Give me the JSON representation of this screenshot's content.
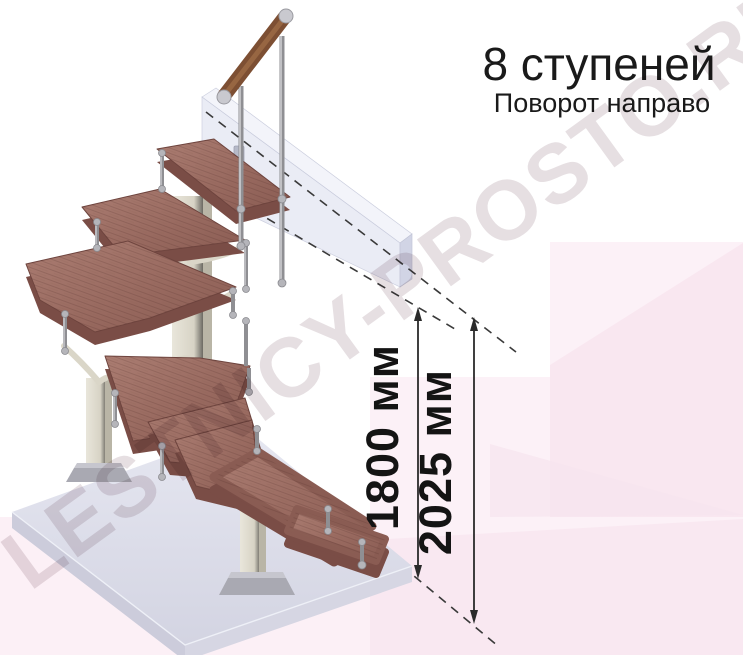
{
  "header": {
    "title": "8 ступеней",
    "subtitle": "Поворот направо"
  },
  "dimensions": [
    {
      "label": "1800 мм"
    },
    {
      "label": "2025 мм"
    }
  ],
  "watermark": {
    "text": "LESTNICY-PROSTO.RU"
  },
  "colors": {
    "wood": "#9a6a60",
    "wood_edge": "#7a4d46",
    "handrail": "#7d4f33",
    "frame": "#d9d5c7",
    "metal": "#8f8f93",
    "floor_slab": "#dbdce8",
    "upper_beam": "#e9ebf5",
    "background_pink": "#fcf0f6",
    "pink_accent": "#f9e7f0",
    "dimension_line": "#2a2a2a",
    "text": "#1a1a1a",
    "watermark": "#e6dfe2"
  }
}
